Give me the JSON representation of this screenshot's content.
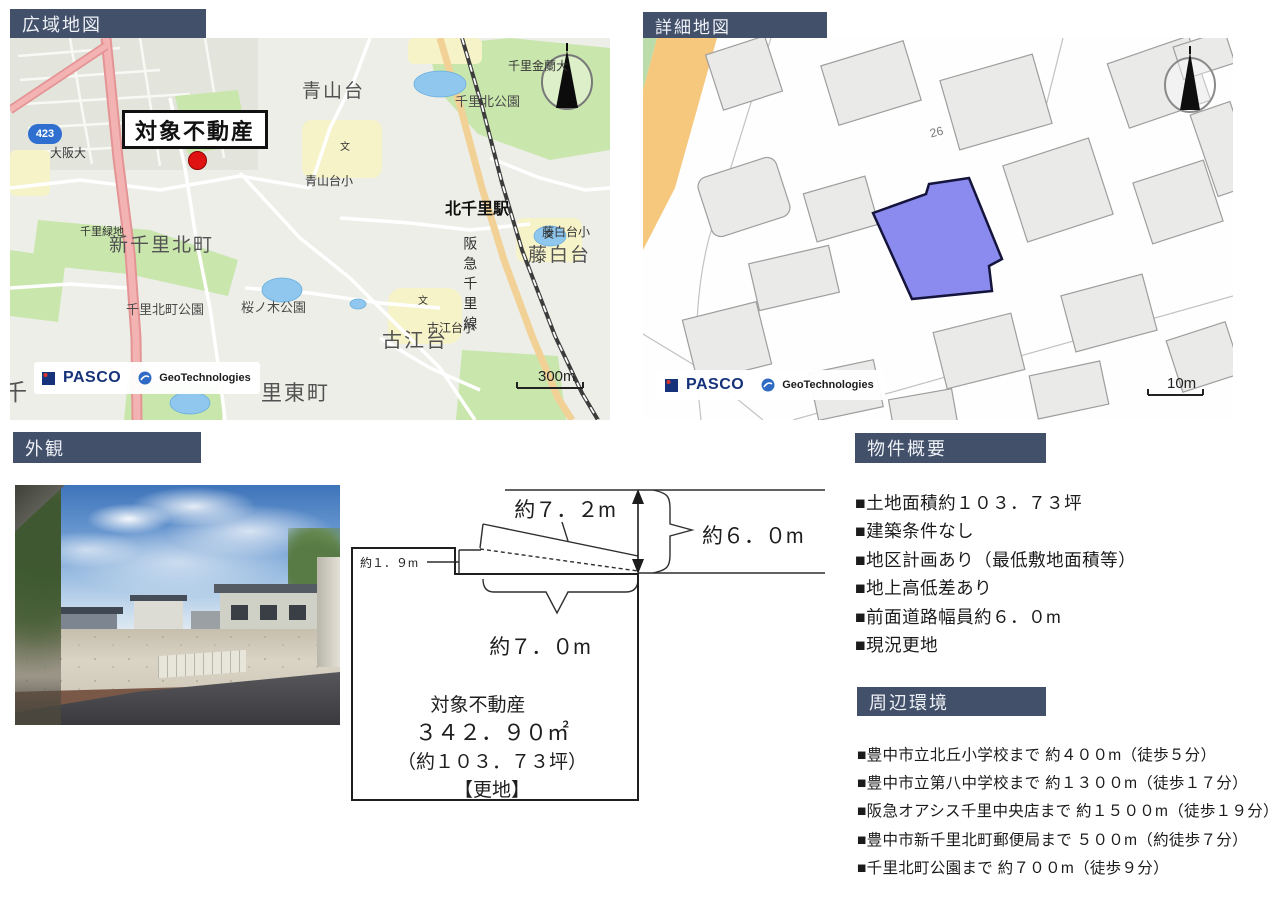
{
  "colors": {
    "header_bg": "#42506a",
    "parcel_fill": "#8b8bef",
    "marker_red": "#e01313"
  },
  "headers": {
    "wide_map": "広域地図",
    "detail_map": "詳細地図",
    "exterior": "外観",
    "overview": "物件概要",
    "environment": "周辺環境"
  },
  "wide_map": {
    "target_label": "対象不動産",
    "route_shield": "423",
    "scale_label": "300m",
    "school_symbol": "文",
    "pasco": "PASCO",
    "geotech": "GeoTechnologies",
    "labels": {
      "aoyamadai": "青山台",
      "aoyamadai_sho": "青山台小",
      "senri_kinran": "千里金蘭大",
      "senri_kita_park": "千里北公園",
      "kitasenri_station": "北千里駅",
      "fujishirodai_sho": "藤白台小",
      "fujishirodai": "藤白台",
      "hankyu_line": "阪急千里線",
      "shinsenri_kitamachi": "新千里北町",
      "senri_ryokuchi": "千里緑地",
      "senri_kitamachi_park": "千里北町公園",
      "sakuranoki_park": "桜ノ木公園",
      "koedai": "古江台",
      "koedai_sho": "古江台小",
      "osaka_univ": "大阪大",
      "sen": "千",
      "sato_higashimachi": "里東町"
    }
  },
  "detail_map": {
    "block_number": "26",
    "scale_label": "10m",
    "pasco": "PASCO",
    "geotech": "GeoTechnologies"
  },
  "plot_diagram": {
    "dim_top": "約７．２m",
    "dim_road_width": "約６．０m",
    "dim_step": "約１．９m",
    "dim_bottom": "約７．０m",
    "title": "対象不動産",
    "area_m2": "３４２．９０㎡",
    "area_tsubo": "（約１０３．７３坪）",
    "condition": "【更地】"
  },
  "overview": {
    "items": [
      "■土地面積約１０３．７３坪",
      "■建築条件なし",
      "■地区計画あり（最低敷地面積等）",
      "■地上高低差あり",
      "■前面道路幅員約６．０m",
      "■現況更地"
    ]
  },
  "environment": {
    "items": [
      "■豊中市立北丘小学校まで 約４００m（徒歩５分）",
      "■豊中市立第八中学校まで 約１３００m（徒歩１７分）",
      "■阪急オアシス千里中央店まで 約１５００m（徒歩１９分）",
      "■豊中市新千里北町郵便局まで ５００m（約徒歩７分）",
      "■千里北町公園まで 約７００m（徒歩９分）"
    ]
  }
}
